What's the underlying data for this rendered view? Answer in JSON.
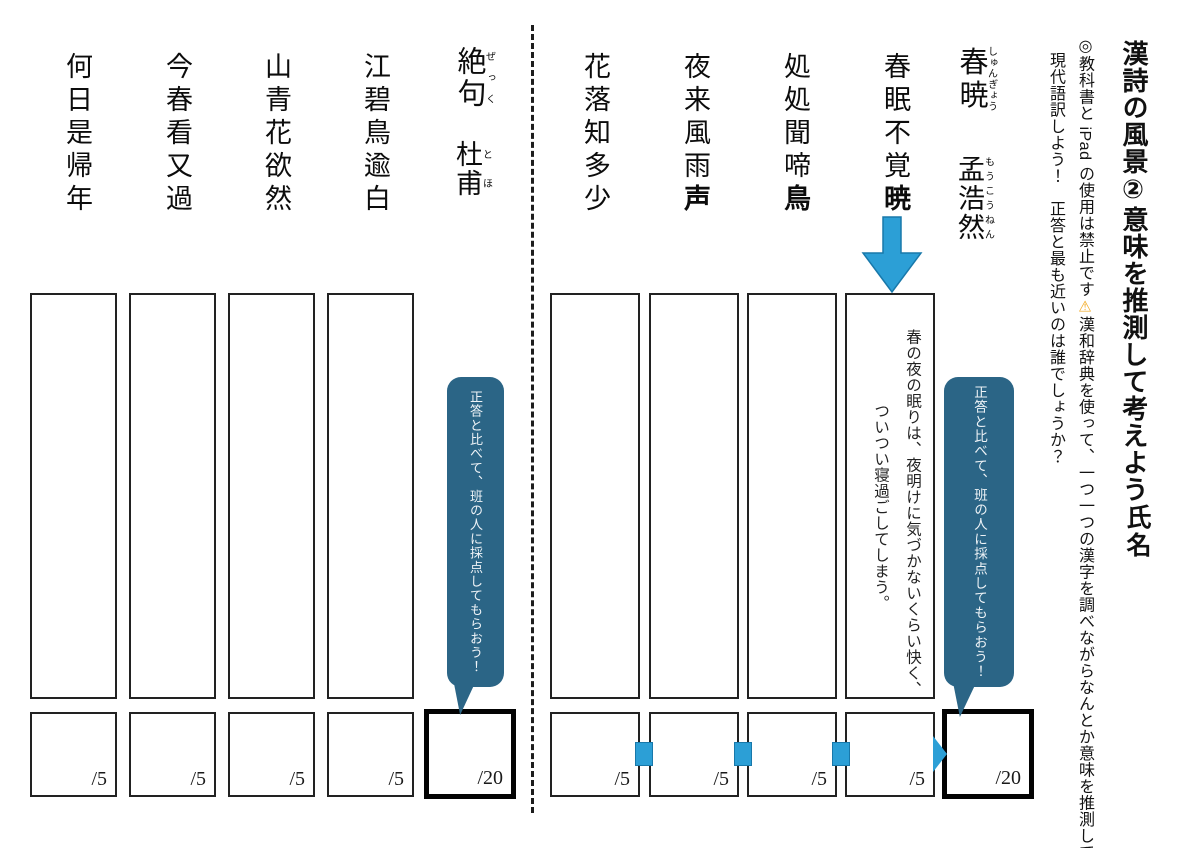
{
  "header": {
    "title": "漢詩の風景②意味を推測して考えよう",
    "name_label": "氏名",
    "instructions": {
      "line1_before": "◎教科書と iPad の使用は禁止です",
      "warning_icon": "⚠",
      "line1_after": "漢和辞典を使って、一つ一つの漢字を調べながらなんとか意味を推測して",
      "line2": "現代語訳しよう！　正答と最も近いのは誰でしょうか？"
    }
  },
  "right_poem": {
    "title_base": "春暁",
    "title_ruby": "しゅんぎょう",
    "author_base": "孟浩然",
    "author_ruby": "もうこうねん",
    "lines": [
      {
        "pre": "春眠不覚",
        "bold": "暁"
      },
      {
        "pre": "処処聞啼",
        "bold": "鳥"
      },
      {
        "pre": "夜来風雨",
        "bold": "声"
      },
      {
        "pre": "花落知多少",
        "bold": ""
      }
    ],
    "answer_col1": "春の夜の眠りは、夜明けに気づかないくらい快く、",
    "answer_col2": "ついつい寝過ごしてしまう。",
    "bubble": "正答と比べて、班の人に採点してもらおう！",
    "score_unit": "/5",
    "total": "/20"
  },
  "left_poem": {
    "title_base": "絶句",
    "title_ruby": "ぜっく",
    "author_base": "杜甫",
    "author_ruby": "とほ",
    "lines": [
      {
        "pre": "江碧鳥逾白",
        "bold": ""
      },
      {
        "pre": "山青花欲然",
        "bold": ""
      },
      {
        "pre": "今春看又過",
        "bold": ""
      },
      {
        "pre": "何日是帰年",
        "bold": ""
      }
    ],
    "bubble": "正答と比べて、班の人に採点してもらおう！",
    "score_unit": "/5",
    "total": "/20"
  },
  "colors": {
    "accent_blue": "#2c9fd6",
    "accent_blue_border": "#1878aa",
    "bubble_blue": "#2b6586",
    "warning_orange": "#f2a71b"
  }
}
